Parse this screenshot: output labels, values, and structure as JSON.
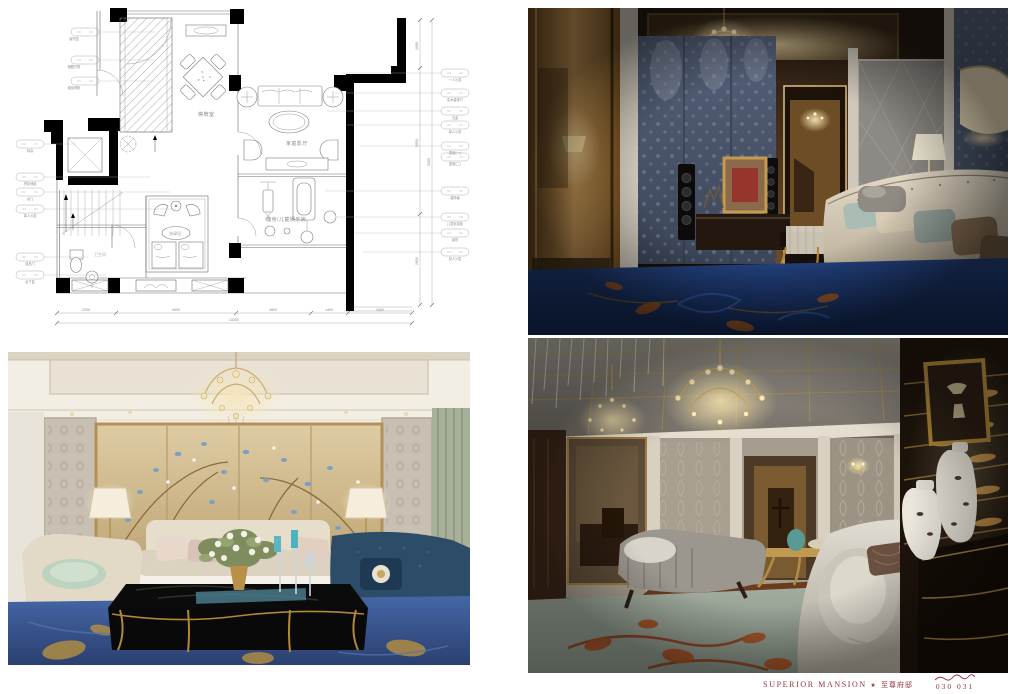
{
  "footer": {
    "title_en": "SUPERIOR MANSION",
    "separator": "★",
    "title_cn": "至尊府邸",
    "page_left": "030",
    "page_right": "031",
    "accent_color": "#9b2f38"
  },
  "floorplan": {
    "rooms": {
      "mahjong": "棋牌室",
      "cinema": "家庭影厅",
      "gym": "健身/儿童娱乐房",
      "bath": "卫生间",
      "spa": "按摩室"
    },
    "dims_bottom": [
      "2200",
      "4500",
      "2800",
      "1400",
      "2400"
    ],
    "dims_bottom_total": "13300",
    "dims_right": [
      "1650",
      "5050",
      "2650"
    ],
    "dims_right_total": "9350",
    "callouts_top": [
      "窗帘盒",
      "暗藏灯带",
      "成品饰柜"
    ],
    "callouts_left": [
      "标高",
      "拼花地毯",
      "台几",
      "单人沙发",
      "成品门",
      "台下盆"
    ],
    "callouts_right": [
      "一人沙发",
      "实木装饰门",
      "五金",
      "单人沙发",
      "壁纸(一)",
      "壁纸(二)",
      "装饰画",
      "儿童玩具柜",
      "窗帘",
      "双人沙发"
    ]
  },
  "photos": {
    "top_right": {
      "name": "home-theater-lounge",
      "palette": {
        "carpet": "#1d3d7c",
        "wall": "#4e5d74",
        "gold_mirror": "#c29455",
        "sofa": "#d9cfc0"
      }
    },
    "bottom_left": {
      "name": "gold-floral-living-room",
      "palette": {
        "panel_gold": "#d8c49c",
        "carpet": "#3b5b98",
        "sofa_cream": "#e3dac8",
        "candle_blue": "#59b6c4"
      }
    },
    "bottom_right": {
      "name": "silver-lounge",
      "palette": {
        "ceiling_gold": "#ac9055",
        "carpet_sage": "#9aa79a",
        "rust": "#a34d20",
        "cabinet": "#1d130b"
      }
    }
  }
}
